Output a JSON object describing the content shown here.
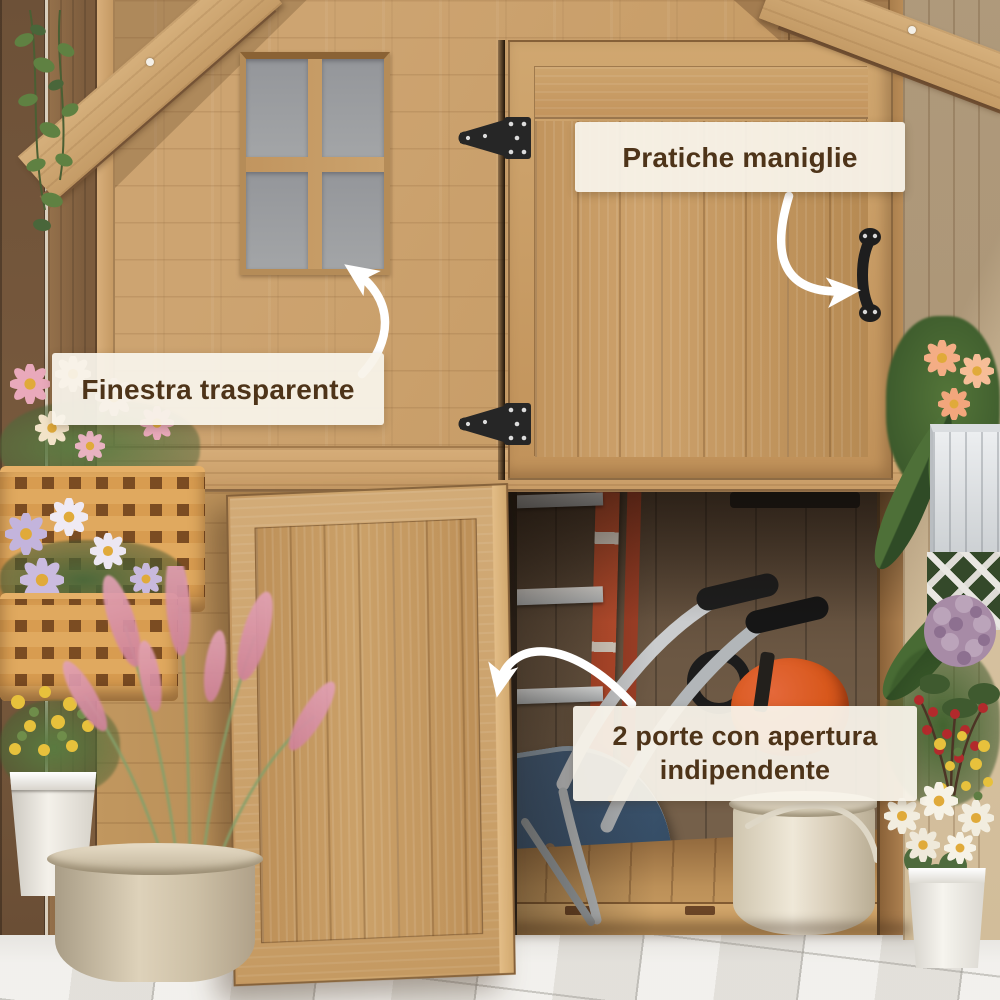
{
  "scene": {
    "description": "Foto prodotto: casetta da giardino in legno con finestra, maniglie nere e due porte con apertura indipendente"
  },
  "callouts": {
    "window": {
      "text": "Finestra trasparente"
    },
    "handles": {
      "text": "Pratiche maniglie"
    },
    "doors": {
      "text": "2 porte con apertura indipendente"
    }
  },
  "colors": {
    "label_bg": "#f8f3ea",
    "label_text": "#4e3419",
    "arrow": "#ffffff",
    "wood_light": "#c89e6b",
    "wood_frame": "#c9a168",
    "wood_roof": "#d6b07c",
    "interior_dark": "#64503e",
    "hardware_black": "#222222",
    "window_glass": "#989a9d",
    "ladder_red": "#c0502f",
    "wheelbarrow_blue": "#40597a",
    "chainsaw_orange": "#d8581c",
    "bucket_cream": "#e9e1d0",
    "paver_gray": "#e6e4df"
  },
  "icons": {
    "hinge": "t-strap-hinge-icon",
    "handle": "door-pull-handle-icon",
    "arrow": "curved-arrow-icon"
  }
}
